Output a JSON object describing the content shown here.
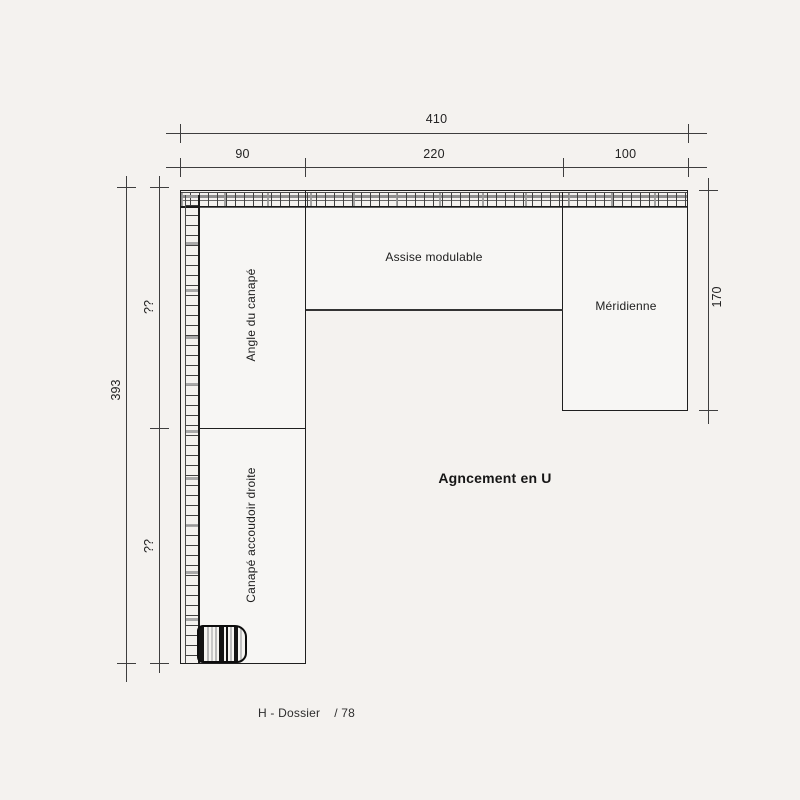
{
  "title": {
    "text": "Agncement en U"
  },
  "caption": {
    "left": "H - Dossier",
    "right": "/ 78"
  },
  "dims": {
    "total_width": "410",
    "width_segments": [
      "90",
      "220",
      "100"
    ],
    "total_height": "393",
    "height_segments": [
      "??",
      "??"
    ],
    "meridienne_height": "170"
  },
  "modules": [
    {
      "label": "Angle du canapé"
    },
    {
      "label": "Assise modulable"
    },
    {
      "label": "Méridienne"
    },
    {
      "label": "Canapé accoudoir droite"
    }
  ],
  "colors": {
    "background": "#f4f2ef",
    "plan_line": "#1f1f1f",
    "dim_line": "#3e3e3e",
    "hatch_gray": "#8f8f8f"
  }
}
